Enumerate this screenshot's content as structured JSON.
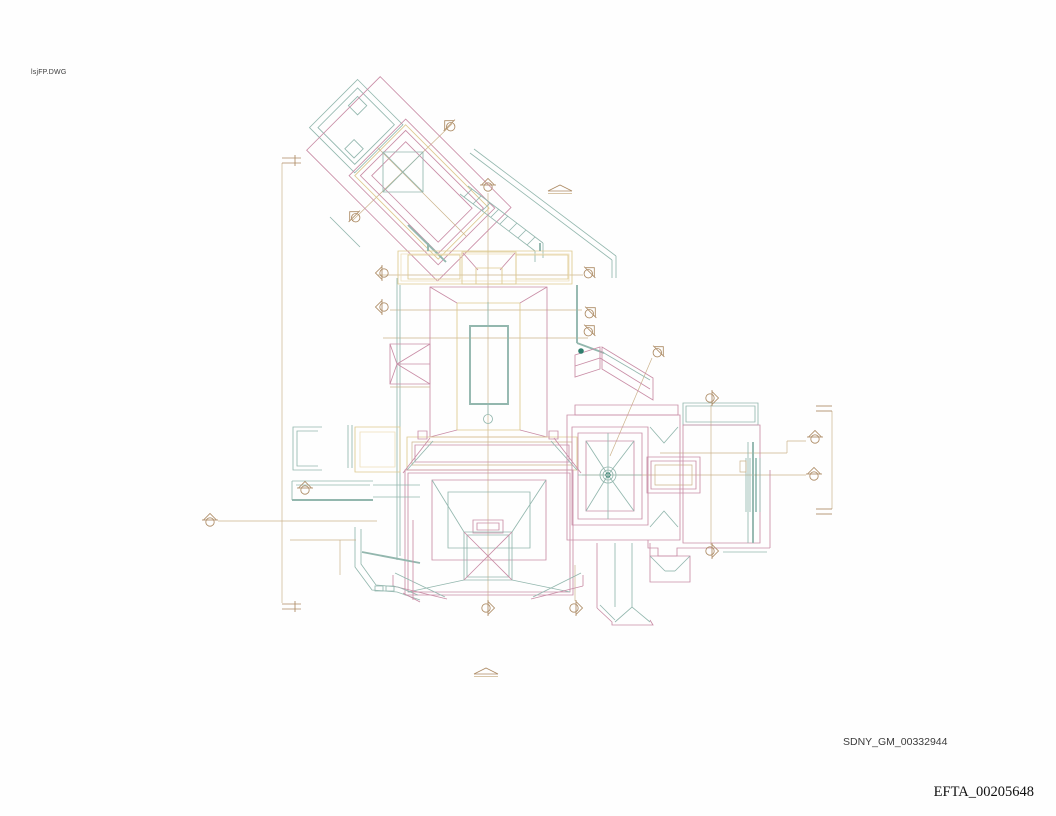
{
  "labels": {
    "drawing_filename": "lsjFP.DWG",
    "bates_number_sdny": "SDNY_GM_00332944",
    "bates_number_efta": "EFTA_00205648"
  },
  "colors": {
    "background": "#fefefe",
    "pink": "#c98da6",
    "teal": "#93b7ae",
    "teal_dark": "#2f7d6d",
    "tan": "#ac8a63",
    "tan_pale": "#cbb28b",
    "yellow": "#ddc98f",
    "yellow_pale": "#eee0bb",
    "text": "#3c3c3c",
    "text_serif": "#101010"
  },
  "drawing": {
    "kind": "cad-roof-plan",
    "layers": [
      "roof-edges-pink",
      "structure-teal",
      "annotations-tan",
      "clerestory-yellow"
    ]
  }
}
